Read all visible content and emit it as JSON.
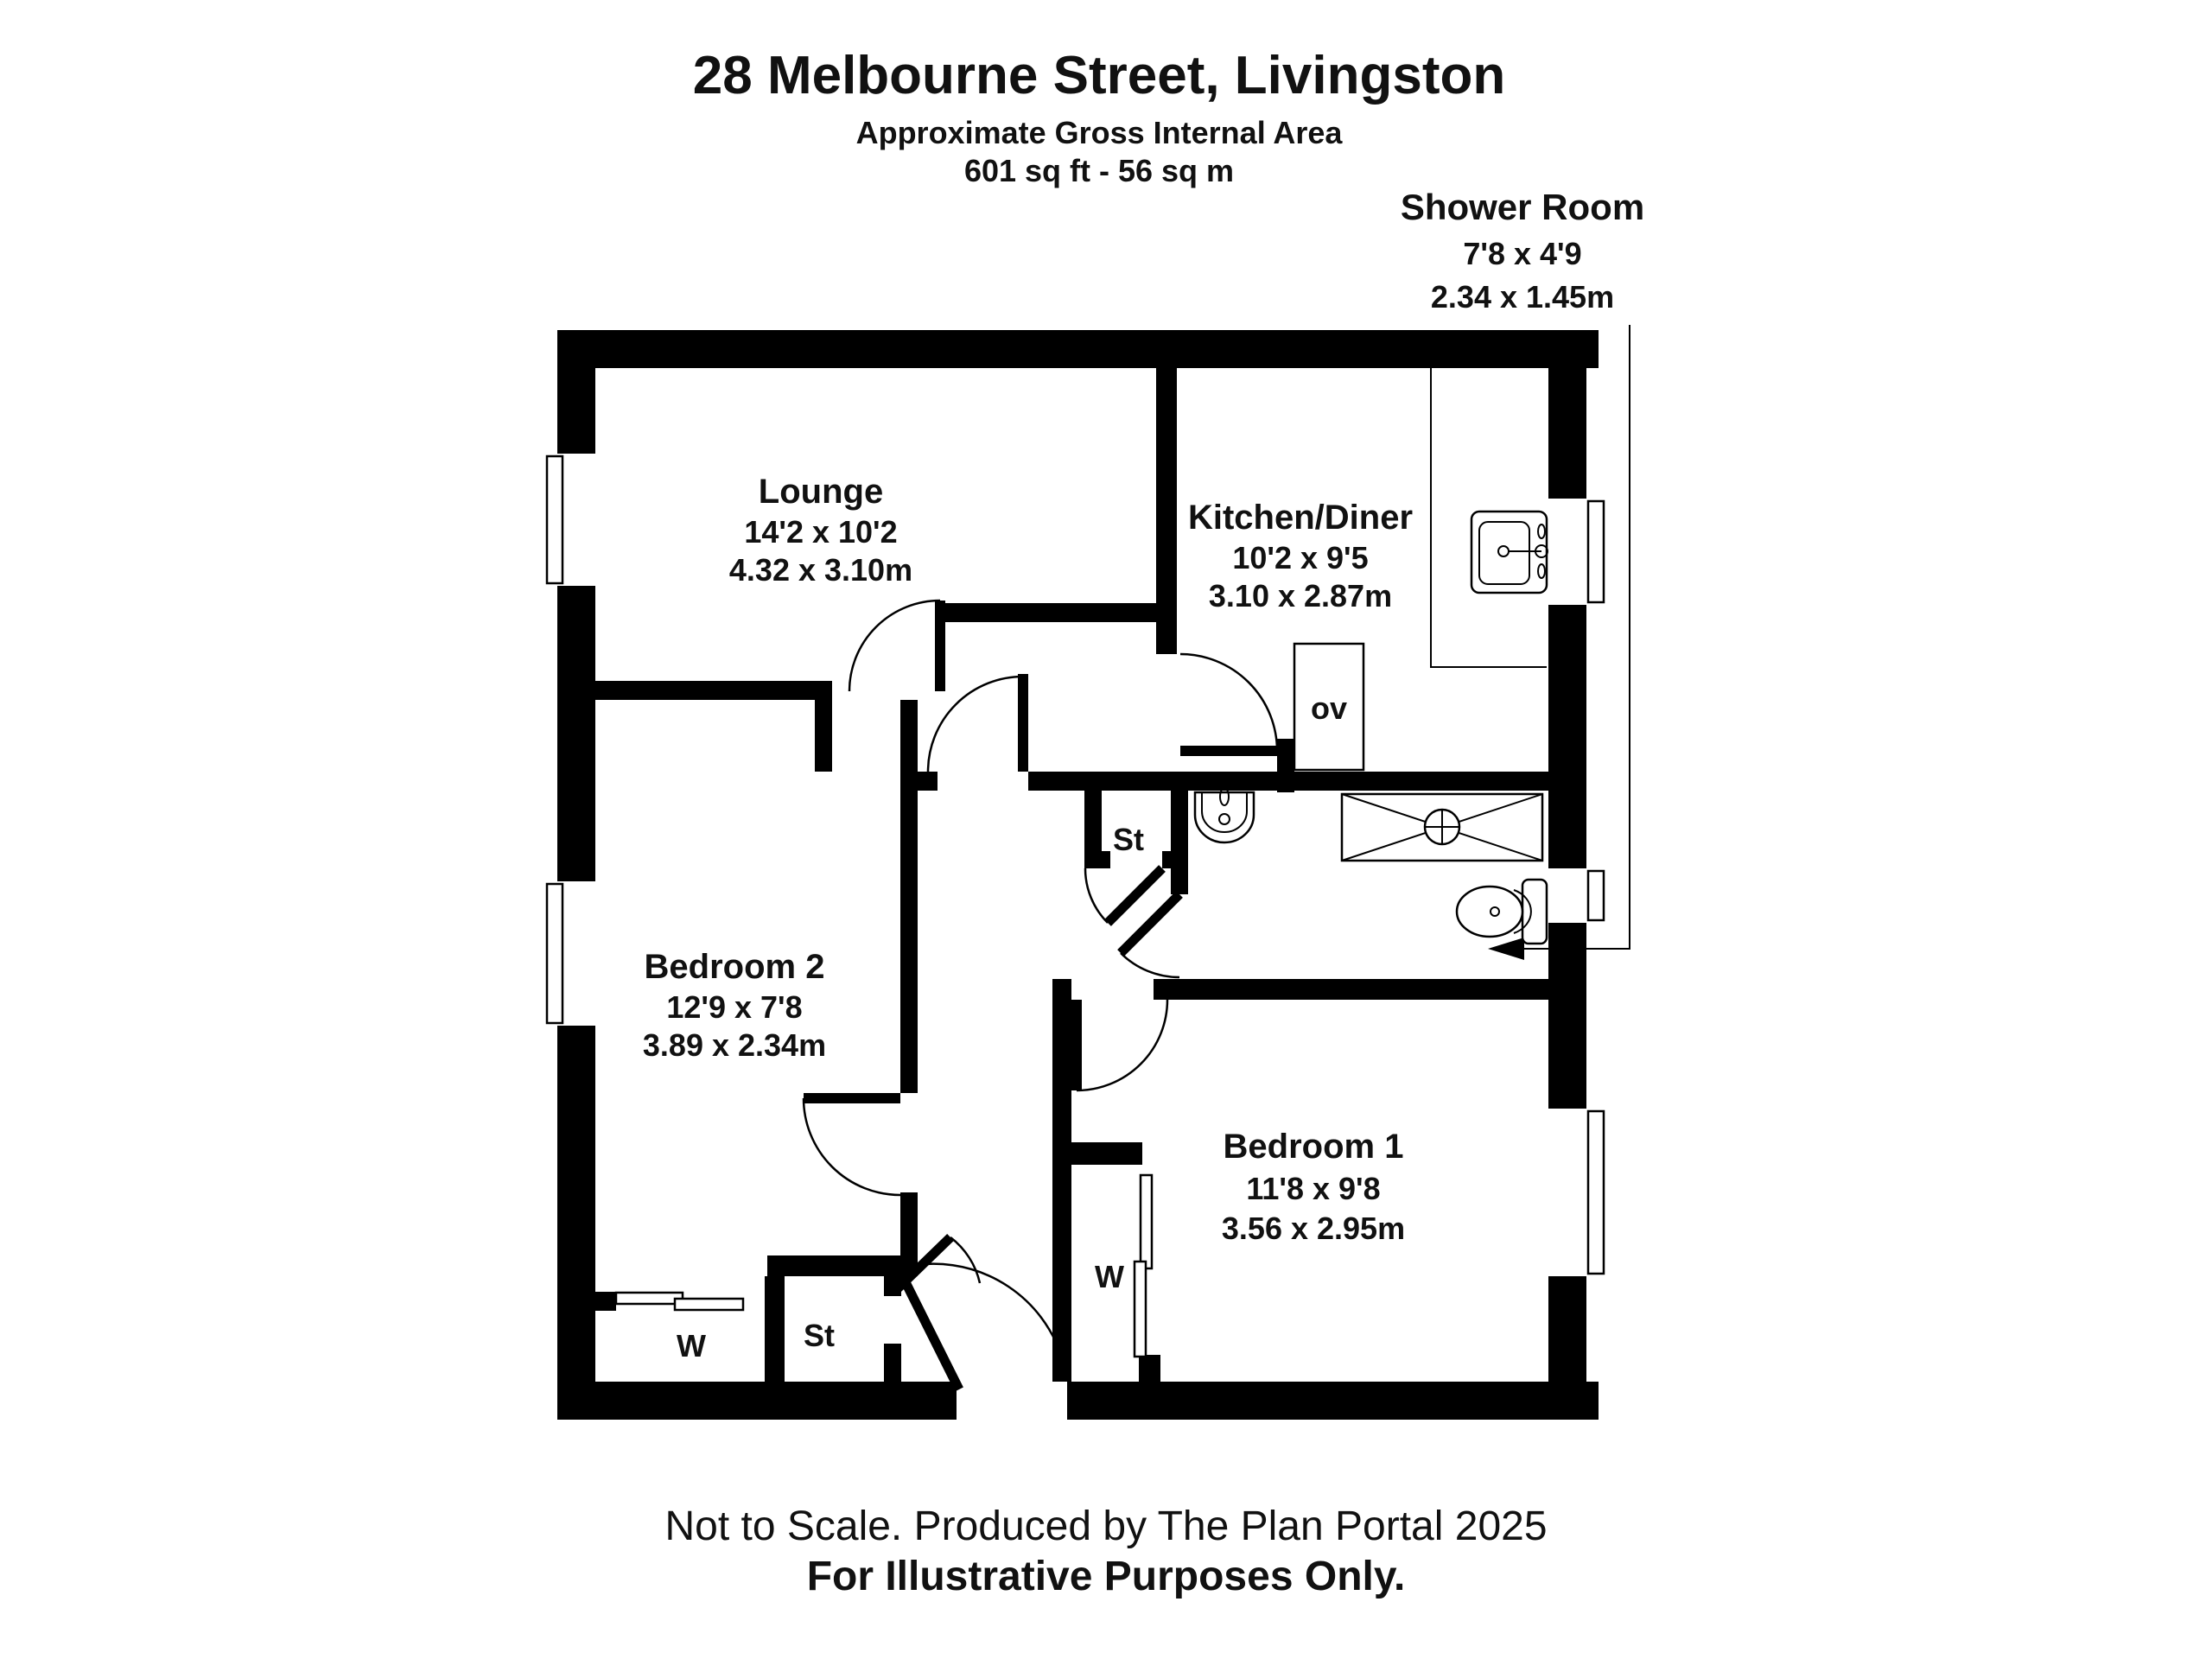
{
  "header": {
    "title": "28 Melbourne Street, Livingston",
    "subtitle": "Approximate Gross Internal Area",
    "area": "601 sq ft - 56 sq m"
  },
  "callout": {
    "name": "Shower Room",
    "dims_imperial": "7'8 x 4'9",
    "dims_metric": "2.34 x 1.45m"
  },
  "rooms": {
    "lounge": {
      "name": "Lounge",
      "dims_imperial": "14'2 x 10'2",
      "dims_metric": "4.32 x 3.10m"
    },
    "kitchen": {
      "name": "Kitchen/Diner",
      "dims_imperial": "10'2 x 9'5",
      "dims_metric": "3.10 x 2.87m"
    },
    "bedroom2": {
      "name": "Bedroom 2",
      "dims_imperial": "12'9 x 7'8",
      "dims_metric": "3.89 x 2.34m"
    },
    "bedroom1": {
      "name": "Bedroom 1",
      "dims_imperial": "11'8 x 9'8",
      "dims_metric": "3.56 x 2.95m"
    }
  },
  "labels": {
    "storage_upper": "St",
    "storage_lower": "St",
    "wardrobe_bedroom2": "W",
    "wardrobe_bedroom1": "W",
    "oven": "ov"
  },
  "footer": {
    "line1": "Not to Scale. Produced by The Plan Portal 2025",
    "line2": "For Illustrative Purposes Only."
  },
  "colors": {
    "wall": "#000000",
    "background": "#ffffff",
    "line": "#111111"
  }
}
